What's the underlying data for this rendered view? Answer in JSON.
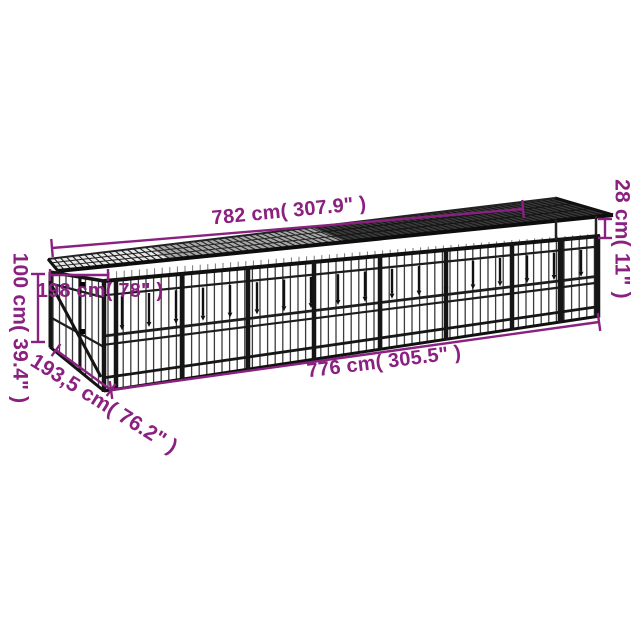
{
  "colors": {
    "accent": "#8A2080",
    "steel": "#1c1c1c"
  },
  "dimensions": {
    "top_length": "782 cm( 307.9\" )",
    "base_length": "776 cm( 305.5\" )",
    "height": "100 cm( 39.4\" )",
    "roof_height": "28 cm( 11\" )",
    "depth_top": "198 cm( 78\" )",
    "depth_bottom": "193,5 cm( 76.2\" )"
  }
}
